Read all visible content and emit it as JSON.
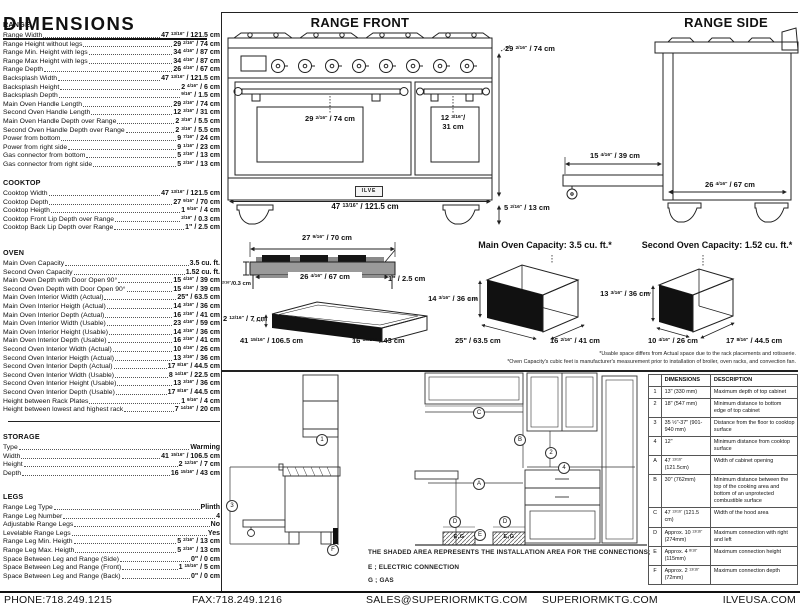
{
  "page_title": "DIMENSIONS",
  "sections": {
    "range": {
      "title": "RANGE",
      "rows": [
        {
          "label": "Range Width",
          "value": "47 13/16\" / 121.5 cm"
        },
        {
          "label": "Range Height without legs",
          "value": "29 2/16\" / 74 cm"
        },
        {
          "label": "Range Min. Height with legs",
          "value": "34 4/16\" / 87 cm"
        },
        {
          "label": "Range Max Height with legs",
          "value": "34 4/16\" / 87 cm"
        },
        {
          "label": "Range Depth",
          "value": "26 4/16\" / 67 cm"
        },
        {
          "label": "Backsplash Width",
          "value": "47 13/16\" / 121.5 cm"
        },
        {
          "label": "Backsplash Height",
          "value": "2 4/16\" / 6 cm"
        },
        {
          "label": "Backsplash Depth",
          "value": "9/16\" / 1.5 cm"
        },
        {
          "label": "Main Oven Handle Length",
          "value": "29 2/16\" / 74 cm"
        },
        {
          "label": "Second Oven Handle Length",
          "value": "12 3/16\" / 31 cm"
        },
        {
          "label": "Main Oven Handle Depth over Range",
          "value": "2 3/16\" / 5.5 cm"
        },
        {
          "label": "Second Oven Handle Depth over Range",
          "value": "2 3/16\" / 5.5 cm"
        },
        {
          "label": "Power from bottom",
          "value": "9 7/16\" / 24 cm"
        },
        {
          "label": "Power from right side",
          "value": "9 1/16\" / 23 cm"
        },
        {
          "label": "Gas connector from bottom",
          "value": "5 2/16\" / 13 cm"
        },
        {
          "label": "Gas connector from right side",
          "value": "5 2/16\" / 13 cm"
        }
      ]
    },
    "cooktop": {
      "title": "COOKTOP",
      "rows": [
        {
          "label": "Cooktop Width",
          "value": "47 13/16\" / 121.5 cm"
        },
        {
          "label": "Cooktop Depth",
          "value": "27 9/16\" / 70 cm"
        },
        {
          "label": "Cooktop Heigth",
          "value": "1 9/16\" / 4 cm"
        },
        {
          "label": "Cooktop Front Lip Depth over Range",
          "value": "2/16\" / 0.3 cm"
        },
        {
          "label": "Cooktop Back Lip Depth over Range",
          "value": "1\" / 2.5 cm"
        }
      ]
    },
    "oven": {
      "title": "OVEN",
      "rows": [
        {
          "label": "Main Oven Capacity",
          "value": "3.5 cu. ft."
        },
        {
          "label": "Second Oven Capacity",
          "value": "1.52 cu. ft."
        },
        {
          "label": "Main Oven Depth with Door Open 90°",
          "value": "15 4/16\" / 39 cm"
        },
        {
          "label": "Second Oven Depth with Door Open 90°",
          "value": "15 4/16\" / 39 cm"
        },
        {
          "label": "Main Oven Interior Width (Actual)",
          "value": "25\" / 63.5 cm"
        },
        {
          "label": "Main Oven Interior Heigth (Actual)",
          "value": "14 3/16\" / 36 cm"
        },
        {
          "label": "Main Oven Interior Depth (Actual)",
          "value": "16 2/16\" / 41 cm"
        },
        {
          "label": "Main Oven Interior Width (Usable)",
          "value": "23 4/16\" / 59 cm"
        },
        {
          "label": "Main Oven Interior Height (Usable)",
          "value": "14 3/16\" / 36 cm"
        },
        {
          "label": "Main Oven Interior Depth (Usable)",
          "value": "16 2/16\" / 41 cm"
        },
        {
          "label": "Second Oven Interior Width (Actual)",
          "value": "10 4/16\" / 26 cm"
        },
        {
          "label": "Second Oven Interior Heigth (Actual)",
          "value": "13 3/16\" / 36 cm"
        },
        {
          "label": "Second Oven Interior Depth (Actual)",
          "value": "17 8/16\" / 44.5 cm"
        },
        {
          "label": "Second Oven Interior Width (Usable)",
          "value": "8 14/16\" / 22.5 cm"
        },
        {
          "label": "Second Oven Interior Height (Usable)",
          "value": "13 3/16\" / 36 cm"
        },
        {
          "label": "Second Oven Interior Depth (Usable)",
          "value": "17 8/16\" / 44.5 cm"
        },
        {
          "label": "Height between Rack Plates",
          "value": "1 9/16\" / 4 cm"
        },
        {
          "label": "Height between lowest and highest rack",
          "value": "7 14/16\" / 20 cm"
        }
      ]
    },
    "storage": {
      "title": "STORAGE",
      "rows": [
        {
          "label": "Type",
          "value": "Warming"
        },
        {
          "label": "Width",
          "value": "41 15/16\" / 106.5 cm"
        },
        {
          "label": "Height",
          "value": "2 12/16\" / 7 cm"
        },
        {
          "label": "Depth",
          "value": "16 15/16\" / 43 cm"
        }
      ]
    },
    "legs": {
      "title": "LEGS",
      "rows": [
        {
          "label": "Range Leg Type",
          "value": "Plinth"
        },
        {
          "label": "Range Leg Number",
          "value": "4"
        },
        {
          "label": "Adjustable Range Legs",
          "value": "No"
        },
        {
          "label": "Levelable Range Legs",
          "value": "Yes"
        },
        {
          "label": "Range Leg Min. Heigth",
          "value": "5 2/16\" / 13 cm"
        },
        {
          "label": "Range Leg Max. Heigth",
          "value": "5 2/16\" / 13 cm"
        },
        {
          "label": "Space Between Leg and Range (Side)",
          "value": "0\" / 0 cm"
        },
        {
          "label": "Space Between Leg and Range (Front)",
          "value": "1 15/16\" / 5 cm"
        },
        {
          "label": "Space Between Leg and Range (Back)",
          "value": "0\" / 0 cm"
        }
      ]
    }
  },
  "front": {
    "title": "RANGE FRONT",
    "logo": "ILVE",
    "dims": {
      "main_handle": "29 2/16\" / 74 cm",
      "second_handle_in": "12 3/16\"/",
      "second_handle_cm": "31 cm",
      "width": "47 13/16\" / 121.5 cm",
      "height": "29 2/16\" / 74 cm",
      "leg_height": "5 2/16\" / 13 cm"
    }
  },
  "side": {
    "title": "RANGE SIDE",
    "dims": {
      "door_open": "15 4/16\" / 39 cm",
      "depth": "26 4/16\" / 67 cm"
    }
  },
  "cooktop_drawing": {
    "dims": {
      "width": "27 9/16\" / 70 cm",
      "inner_width": "26 4/16\" / 67 cm",
      "back_lip": "1\" / 2.5 cm",
      "front_lip": "2/16\"/0.3 cm"
    }
  },
  "storage_drawing": {
    "dims": {
      "height": "2 12/16\" / 7 cm",
      "width": "41 15/16\" / 106.5 cm",
      "depth": "16 15/16\" / 43 cm"
    }
  },
  "ovens": {
    "main": {
      "title": "Main Oven Capacity: 3.5 cu. ft.*",
      "height": "14 3/16\" / 36 cm",
      "width": "25\" / 63.5 cm",
      "depth": "16 2/16\" / 41 cm"
    },
    "second": {
      "title": "Second Oven Capacity: 1.52 cu. ft.*",
      "height": "13 3/16\" / 36 cm",
      "width": "10 4/16\" / 26 cm",
      "depth": "17 8/16\" / 44.5 cm"
    },
    "footnote1": "*Usable space differs from Actual space due to the rack placements and rotisserie.",
    "footnote2": "*Oven Capacity's cubic feet is manufacturer's measurement prior to installation of broiler, oven racks, and convection fan."
  },
  "install": {
    "note": "THE SHADED AREA REPRESENTS THE INSTALLATION AREA FOR THE CONNECTIONS;",
    "electric": "E ; ELECTRIC CONNECTION",
    "gas": "G ; GAS",
    "shaded_label": "E,G",
    "markers": {
      "m1": "1",
      "m2": "2",
      "m3": "3",
      "m4": "4",
      "a": "A",
      "b": "B",
      "c": "C",
      "d": "D",
      "e": "E",
      "f": "F"
    }
  },
  "dim_table": {
    "col_dim": "DIMENSIONS",
    "col_desc": "DESCRIPTION",
    "rows": [
      {
        "k": "1",
        "dim": "13\" (330 mm)",
        "desc": "Maximum depth of top cabinet"
      },
      {
        "k": "2",
        "dim": "18\" (547 mm)",
        "desc": "Minimum distance to bottom edge of top cabinet"
      },
      {
        "k": "3",
        "dim": "35 ½\"-37\" (901-940 mm)",
        "desc": "Distance from the floor to cooktop surface"
      },
      {
        "k": "4",
        "dim": "12\"",
        "desc": "Minimum distance from cooktop surface"
      },
      {
        "k": "A",
        "dim": "47 13/16\" (121.5cm)",
        "desc": "Width of cabinet opening"
      },
      {
        "k": "B",
        "dim": "30\" (762mm)",
        "desc": "Minimum distance between the top of the cooking area and bottom of an unprotected combustible surface"
      },
      {
        "k": "C",
        "dim": "47 13/16\" (121.5 cm)",
        "desc": "Width of the hood area"
      },
      {
        "k": "D",
        "dim": "Approx. 10 13/16\" (274mm)",
        "desc": "Maximum connection with right and left"
      },
      {
        "k": "E",
        "dim": "Approx. 4 8/16\" (115mm)",
        "desc": "Maximum connection height"
      },
      {
        "k": "F",
        "dim": "Approx. 2 13/16\" (72mm)",
        "desc": "Maximum connection depth"
      }
    ]
  },
  "footer": {
    "phone": "PHONE:718.249.1215",
    "fax": "FAX:718.249.1216",
    "email": "SALES@SUPERIORMKTG.COM",
    "website": "SUPERIORMKTG.COM",
    "brand": "ILVEUSA.COM"
  }
}
